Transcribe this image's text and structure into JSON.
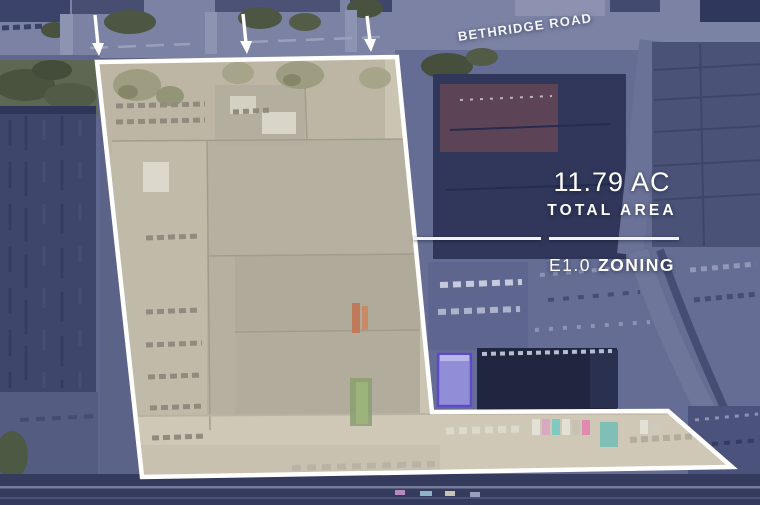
{
  "image": {
    "road_label": "BETHRIDGE ROAD",
    "stats": {
      "area_value": "11.79 AC",
      "area_label": "TOTAL AREA",
      "zoning_value": "E1.0",
      "zoning_label": "ZONING"
    },
    "icons": {
      "down_arrow": "↓",
      "down_arrow_count": 3
    },
    "colors": {
      "overlay_navy": "#5c6389",
      "parcel_fill": "#c1baa9",
      "boundary_white": "#ffffff",
      "annotation_text": "#ffffff",
      "dark_building": "#31375a",
      "bottom_band": "#343b5d"
    }
  }
}
